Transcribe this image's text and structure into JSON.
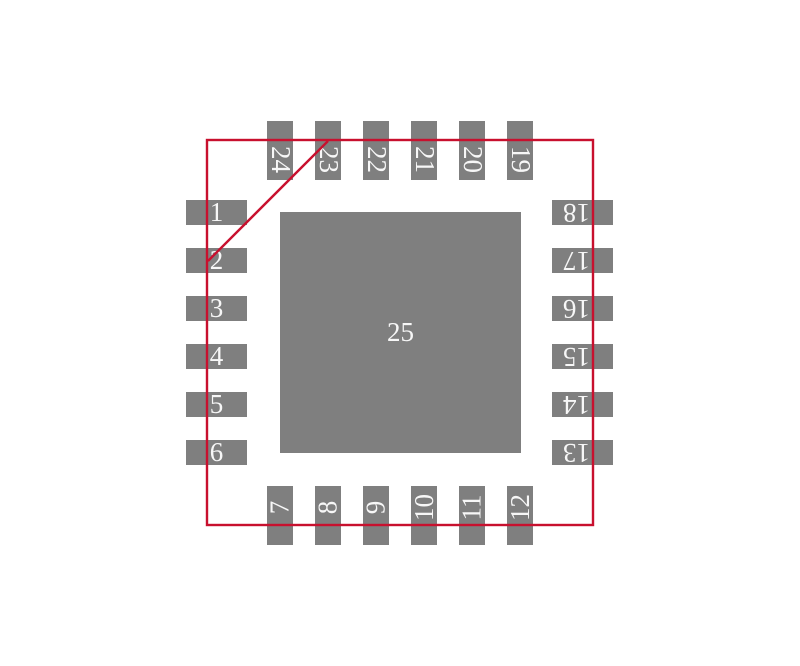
{
  "diagram": {
    "center_pad_label": "25",
    "pads_top": [
      "24",
      "23",
      "22",
      "21",
      "20",
      "19"
    ],
    "pads_bottom": [
      "7",
      "8",
      "9",
      "10",
      "11",
      "12"
    ],
    "pads_left": [
      "1",
      "2",
      "3",
      "4",
      "5",
      "6"
    ],
    "pads_right": [
      "18",
      "17",
      "16",
      "15",
      "14",
      "13"
    ]
  },
  "colors": {
    "pad_fill": "#7F7F7F",
    "pad_text": "#F7F7F7",
    "outline": "#C8102E",
    "background": "#FFFFFF"
  }
}
